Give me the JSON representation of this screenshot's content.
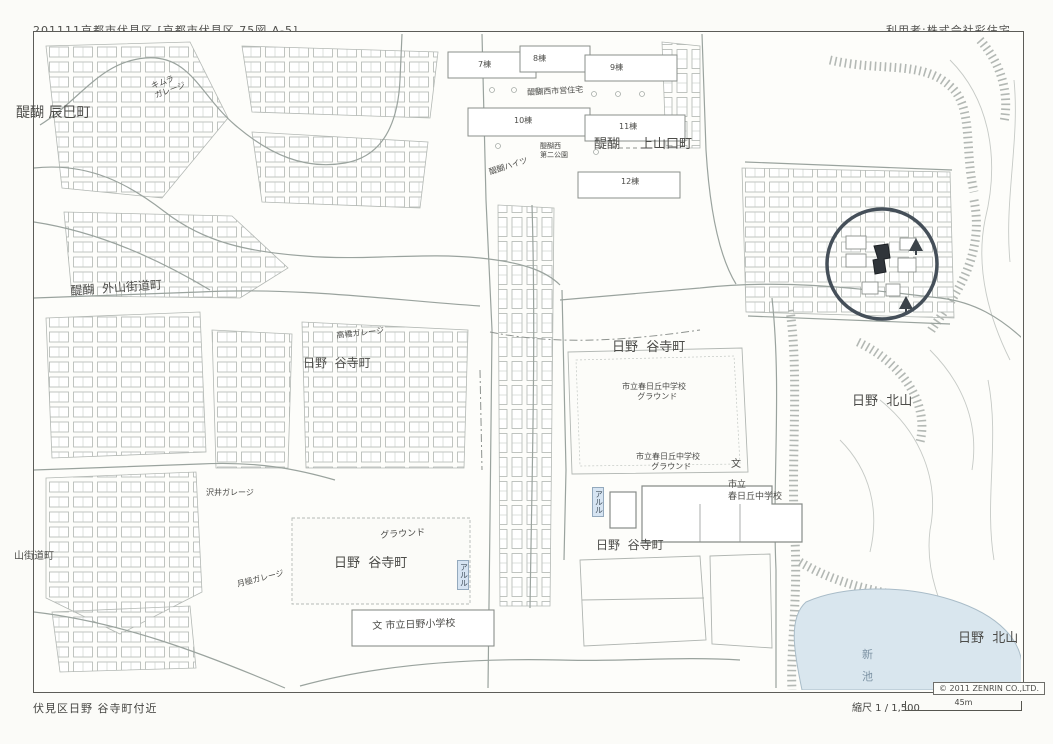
{
  "header": {
    "left": "201111京都市伏見区 [京都市伏見区 75図 A-5]",
    "right": "利用者:株式会社彩住宅"
  },
  "footer": {
    "area": "伏見区日野 谷寺町付近",
    "copyright": "© 2011 ZENRIN CO.,LTD.",
    "scale_label": "縮尺 1 / 1,500",
    "scale_distance": "45m"
  },
  "map": {
    "colors": {
      "pond": "#d9e6ee",
      "marker_circle": "#454f59",
      "highlight_building": "#30353a",
      "line_gray": "#9aa39e"
    },
    "labels": {
      "daigo_tatsumicho": "醍醐 辰巳町",
      "kimura_garage": "キムラ\nガレージ",
      "daigo_toyamakaidocho": "醍醐  外山街道町",
      "yamakaidocho": "山街道町",
      "daigonishi_shiei_jutaku": "醍醐西市営住宅",
      "bldg7": "7棟",
      "bldg8": "8棟",
      "bldg9": "9棟",
      "bldg10": "10棟",
      "bldg11": "11棟",
      "bldg12": "12棟",
      "daigonishi_park": "醍醐西\n第二公園",
      "daigo_heights": "醍醐ハイツ",
      "kamiyamaguchi_prefix": "醍醐",
      "kamiyamaguchi_name": "上山口町",
      "hino_tanidera_nw": "日野  谷寺町",
      "hino_tanidera_ne": "日野  谷寺町",
      "hino_tanidera_s": "日野  谷寺町",
      "hino_tanidera_se": "日野  谷寺町",
      "kasugaoka_ground_upper": "市立春日丘中学校\n      グラウンド",
      "kasugaoka_ground_lower": "市立春日丘中学校\n      グラウンド",
      "school_mark_1": "文",
      "kasugaoka_school": "市立\n春日丘中学校",
      "hino_elementary": "文 市立日野小学校",
      "hino_kitayama_1": "日野  北山",
      "hino_kitayama_2": "日野  北山",
      "shin_ike": "新\n池",
      "takahashi_garage": "高橋ガレージ",
      "sawai_garage": "沢井ガレージ",
      "ground_sw": "グラウンド",
      "tsukigime_garage": "月極ガレージ",
      "aruru_1": "アルル",
      "aruru_2": "アルル"
    }
  }
}
